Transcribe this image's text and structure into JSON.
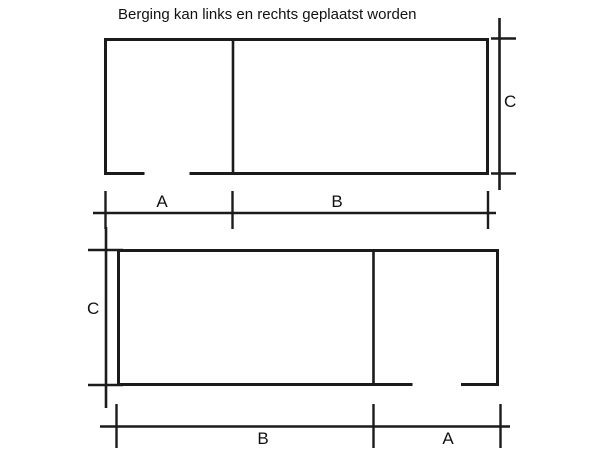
{
  "title": "Berging kan links en rechts  geplaatst worden",
  "colors": {
    "line": "#1b1b1b",
    "text": "#111111",
    "background": "#ffffff"
  },
  "top_plan": {
    "label_left_section": "A",
    "label_right_section": "B",
    "label_height": "C"
  },
  "bottom_plan": {
    "label_left_section": "B",
    "label_right_section": "A",
    "label_height": "C"
  }
}
